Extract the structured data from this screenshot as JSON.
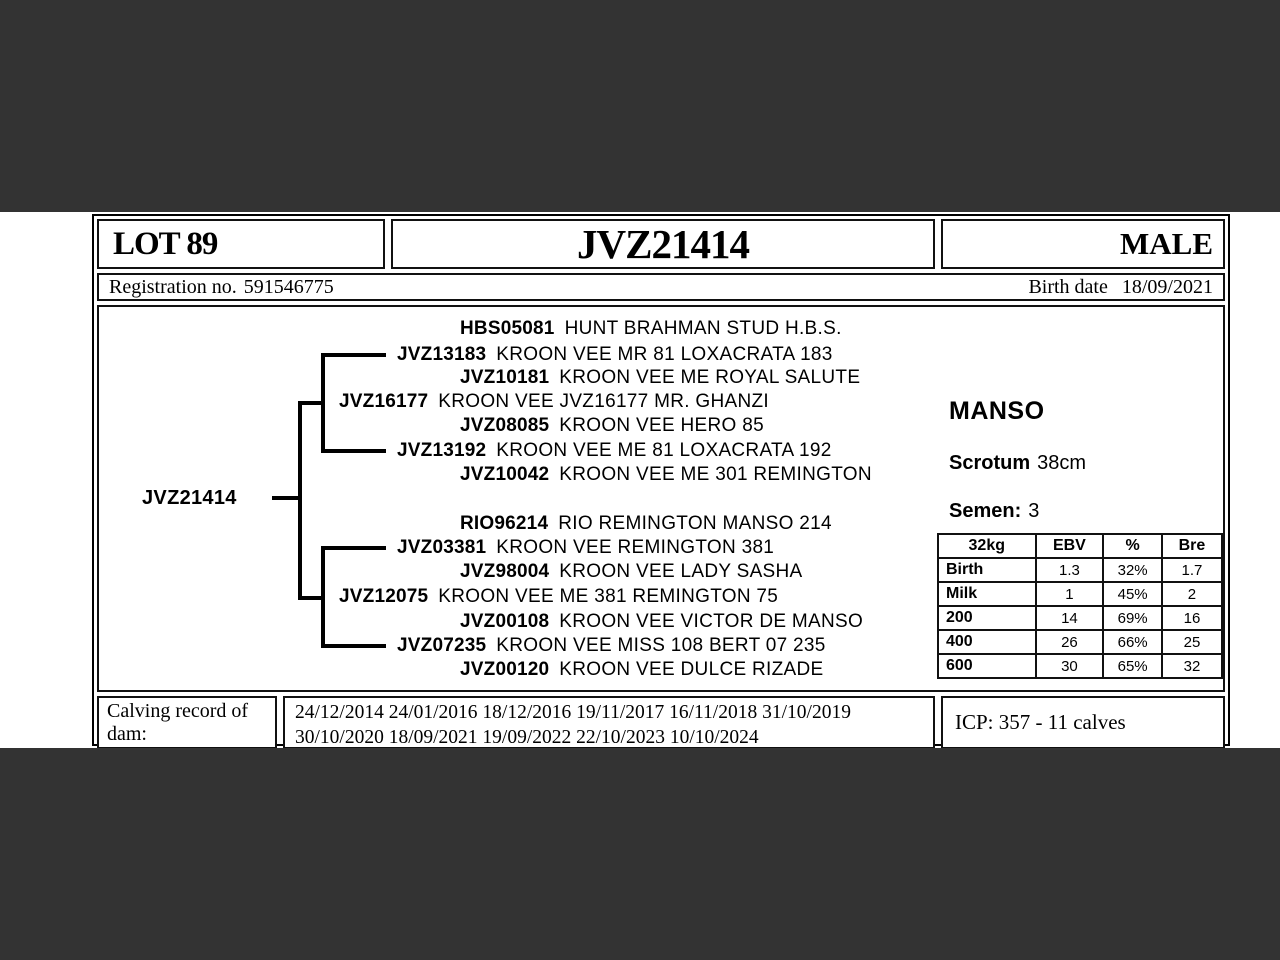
{
  "colors": {
    "letterbox": "#333333",
    "card_background": "#ffffff",
    "border": "#000000",
    "text": "#000000"
  },
  "header": {
    "lot": "LOT 89",
    "animal_id": "JVZ21414",
    "sex": "MALE"
  },
  "registration": {
    "reg_label": "Registration no.",
    "reg_value": "591546775",
    "birth_label": "Birth date",
    "birth_value": "18/09/2021"
  },
  "pedigree": {
    "subject": "JVZ21414",
    "rows": [
      {
        "code": "HBS05081",
        "name": "HUNT BRAHMAN STUD H.B.S."
      },
      {
        "code": "JVZ13183",
        "name": "KROON VEE MR 81 LOXACRATA 183"
      },
      {
        "code": "JVZ10181",
        "name": "KROON VEE ME ROYAL SALUTE"
      },
      {
        "code": "JVZ16177",
        "name": "KROON VEE JVZ16177 MR. GHANZI"
      },
      {
        "code": "JVZ08085",
        "name": "KROON VEE HERO 85"
      },
      {
        "code": "JVZ13192",
        "name": "KROON VEE ME 81 LOXACRATA 192"
      },
      {
        "code": "JVZ10042",
        "name": "KROON VEE ME 301 REMINGTON"
      },
      {
        "code": "RIO96214",
        "name": "RIO REMINGTON MANSO 214"
      },
      {
        "code": "JVZ03381",
        "name": "KROON VEE REMINGTON 381"
      },
      {
        "code": "JVZ98004",
        "name": "KROON VEE LADY SASHA"
      },
      {
        "code": "JVZ12075",
        "name": "KROON VEE ME 381 REMINGTON 75"
      },
      {
        "code": "JVZ00108",
        "name": "KROON VEE VICTOR DE MANSO"
      },
      {
        "code": "JVZ07235",
        "name": "KROON VEE MISS 108 BERT 07 235"
      },
      {
        "code": "JVZ00120",
        "name": "KROON VEE DULCE RIZADE"
      }
    ]
  },
  "info": {
    "breed": "MANSO",
    "scrotum_label": "Scrotum",
    "scrotum_value": "38cm",
    "semen_label": "Semen:",
    "semen_value": "3"
  },
  "ebv_table": {
    "headers": [
      "32kg",
      "EBV",
      "%",
      "Bre"
    ],
    "rows": [
      {
        "label": "Birth",
        "ebv": "1.3",
        "pct": "32%",
        "bre": "1.7"
      },
      {
        "label": "Milk",
        "ebv": "1",
        "pct": "45%",
        "bre": "2"
      },
      {
        "label": "200",
        "ebv": "14",
        "pct": "69%",
        "bre": "16"
      },
      {
        "label": "400",
        "ebv": "26",
        "pct": "66%",
        "bre": "25"
      },
      {
        "label": "600",
        "ebv": "30",
        "pct": "65%",
        "bre": "32"
      }
    ]
  },
  "bottom": {
    "calving_label": "Calving record of dam:",
    "dates_line1": "24/12/2014 24/01/2016 18/12/2016 19/11/2017 16/11/2018 31/10/2019",
    "dates_line2": "30/10/2020 18/09/2021 19/09/2022 22/10/2023 10/10/2024",
    "icp": "ICP: 357 - 11 calves"
  }
}
